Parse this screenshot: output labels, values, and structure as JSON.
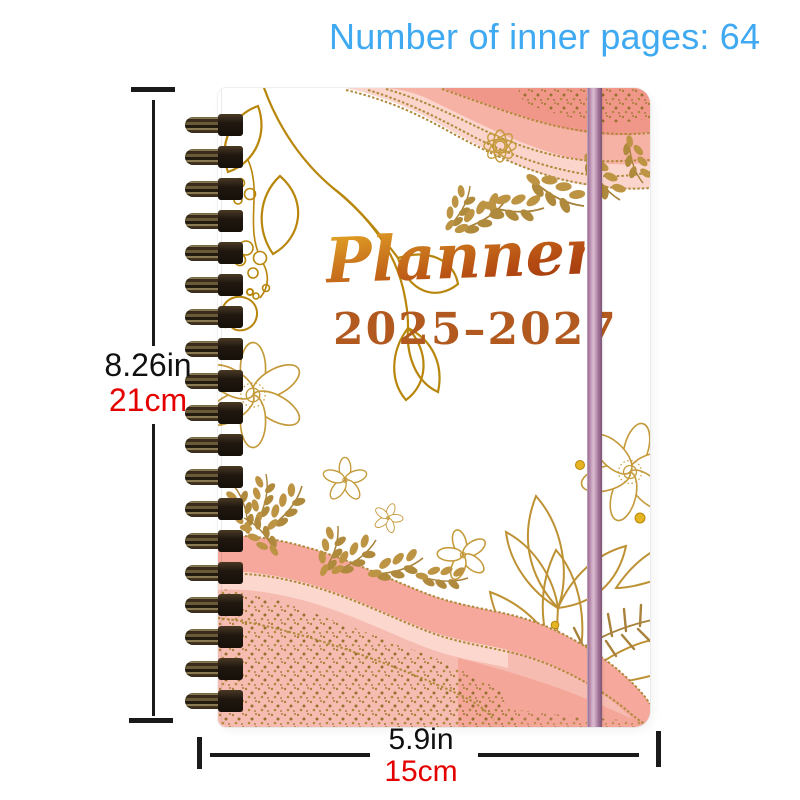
{
  "header": {
    "text": "Number of inner pages: 64",
    "color": "#3FA9F1"
  },
  "notebook": {
    "title": "Planner",
    "years": "2025–2027",
    "coil_count": 19,
    "colors": {
      "title_gradient_top": "#E8B125",
      "title_gradient_bottom": "#9C330C",
      "years_text": "#B2591F",
      "elastic_band": "#BD93B4",
      "watercolor_pink": "#F6ADA2",
      "gold_foil": "#BE9440",
      "coil_metal": "#3A2D1B"
    }
  },
  "dimensions": {
    "height": {
      "inches": "8.26in",
      "centimeters": "21cm"
    },
    "width": {
      "inches": "5.9in",
      "centimeters": "15cm"
    },
    "inches_color": "#111111",
    "cm_color": "#E50000"
  }
}
